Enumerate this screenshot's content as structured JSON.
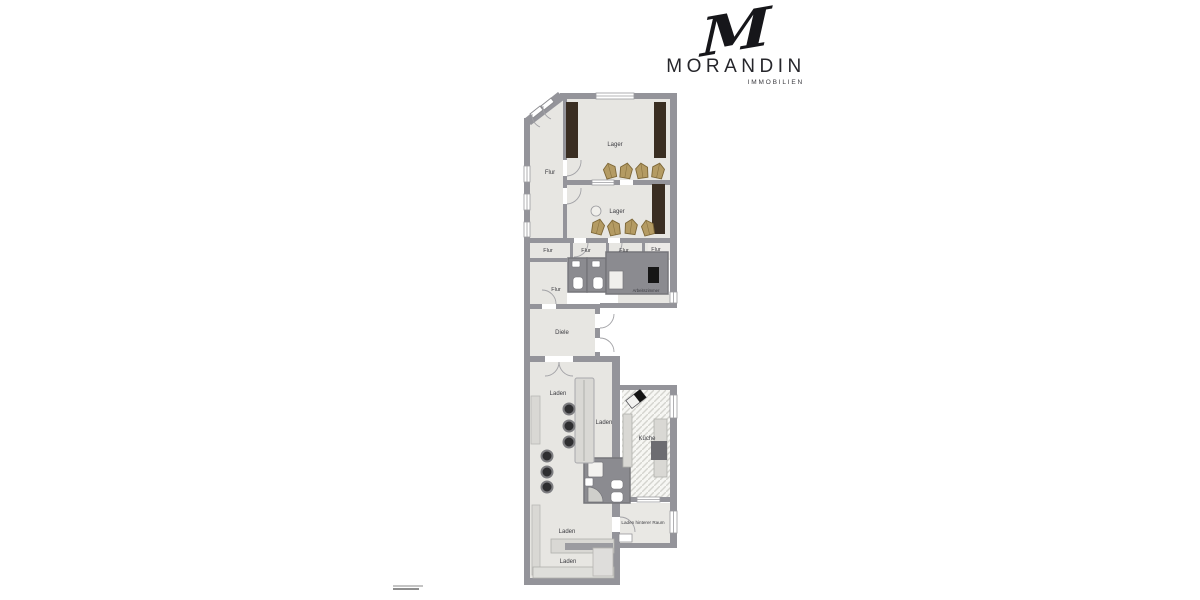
{
  "logo": {
    "monogram": "M",
    "name": "MORANDIN",
    "subtitle": "IMMOBILIEN"
  },
  "palette": {
    "background": "#ffffff",
    "wall": "#94949a",
    "floor_light": "#e7e6e2",
    "floor_dark": "#8b8b90",
    "shelf_brown": "#3a2e22",
    "sack_tan": "#b49b63",
    "counter_gray": "#d9d8d4",
    "stool_dark": "#2e2e30",
    "appliance_black": "#161616",
    "label_text": "#3c3c41",
    "logo_text": "#26262b"
  },
  "rooms": {
    "flur_upper": "Flur",
    "lager_1": "Lager",
    "lager_2": "Lager",
    "flur_a": "Flur",
    "flur_b": "Flur",
    "flur_c": "Flur",
    "flur_d": "Flur",
    "flur_lower": "Flur",
    "arbeitszimmer": "Arbeitszimmer",
    "diele": "Diele",
    "laden_1": "Laden",
    "laden_2": "Laden",
    "kueche": "Küche",
    "laden_3": "Laden",
    "laden_hinterer_raum": "Laden hinterer Raum",
    "laden_4": "Laden"
  }
}
